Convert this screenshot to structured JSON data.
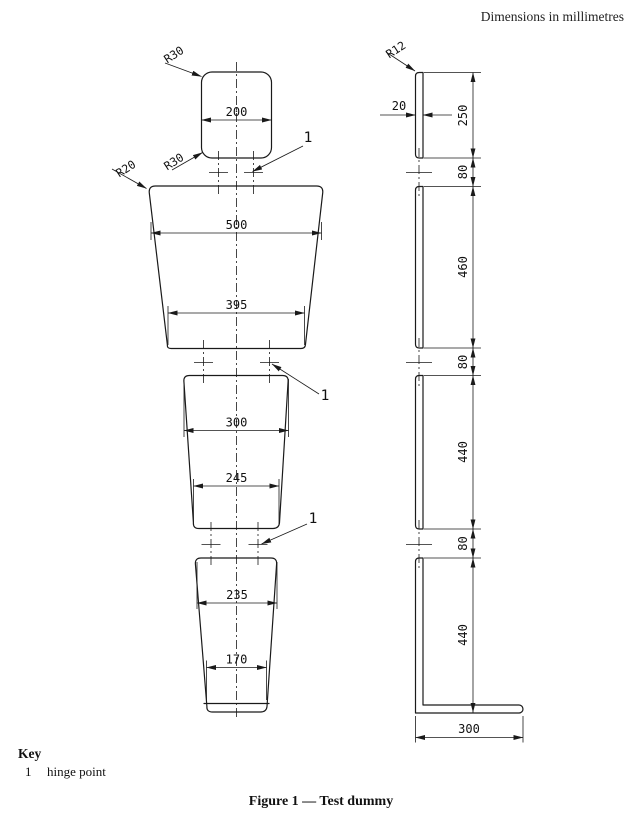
{
  "note": "Dimensions in millimetres",
  "front_view": {
    "radius_labels": {
      "head_top": "R30",
      "head_bottom": "R30",
      "torso": "R20"
    },
    "dims": {
      "head_width": "200",
      "torso_top_width": "500",
      "torso_bottom_width": "395",
      "upper_leg_top_width": "300",
      "upper_leg_bottom_width": "245",
      "lower_leg_top_width": "235",
      "lower_leg_bottom_width": "170"
    },
    "hinge_labels": [
      "1",
      "1",
      "1"
    ]
  },
  "side_view": {
    "radius_label": "R12",
    "dims": {
      "thickness": "20",
      "head_height": "250",
      "gap_head_torso": "80",
      "torso_height": "460",
      "gap_torso_leg": "80",
      "upper_leg_height": "440",
      "gap_leg_leg": "80",
      "lower_leg_height": "440",
      "foot_length": "300"
    }
  },
  "key": {
    "title": "Key",
    "items": [
      {
        "ref": "1",
        "label": "hinge point"
      }
    ]
  },
  "caption": "Figure 1 — Test dummy"
}
